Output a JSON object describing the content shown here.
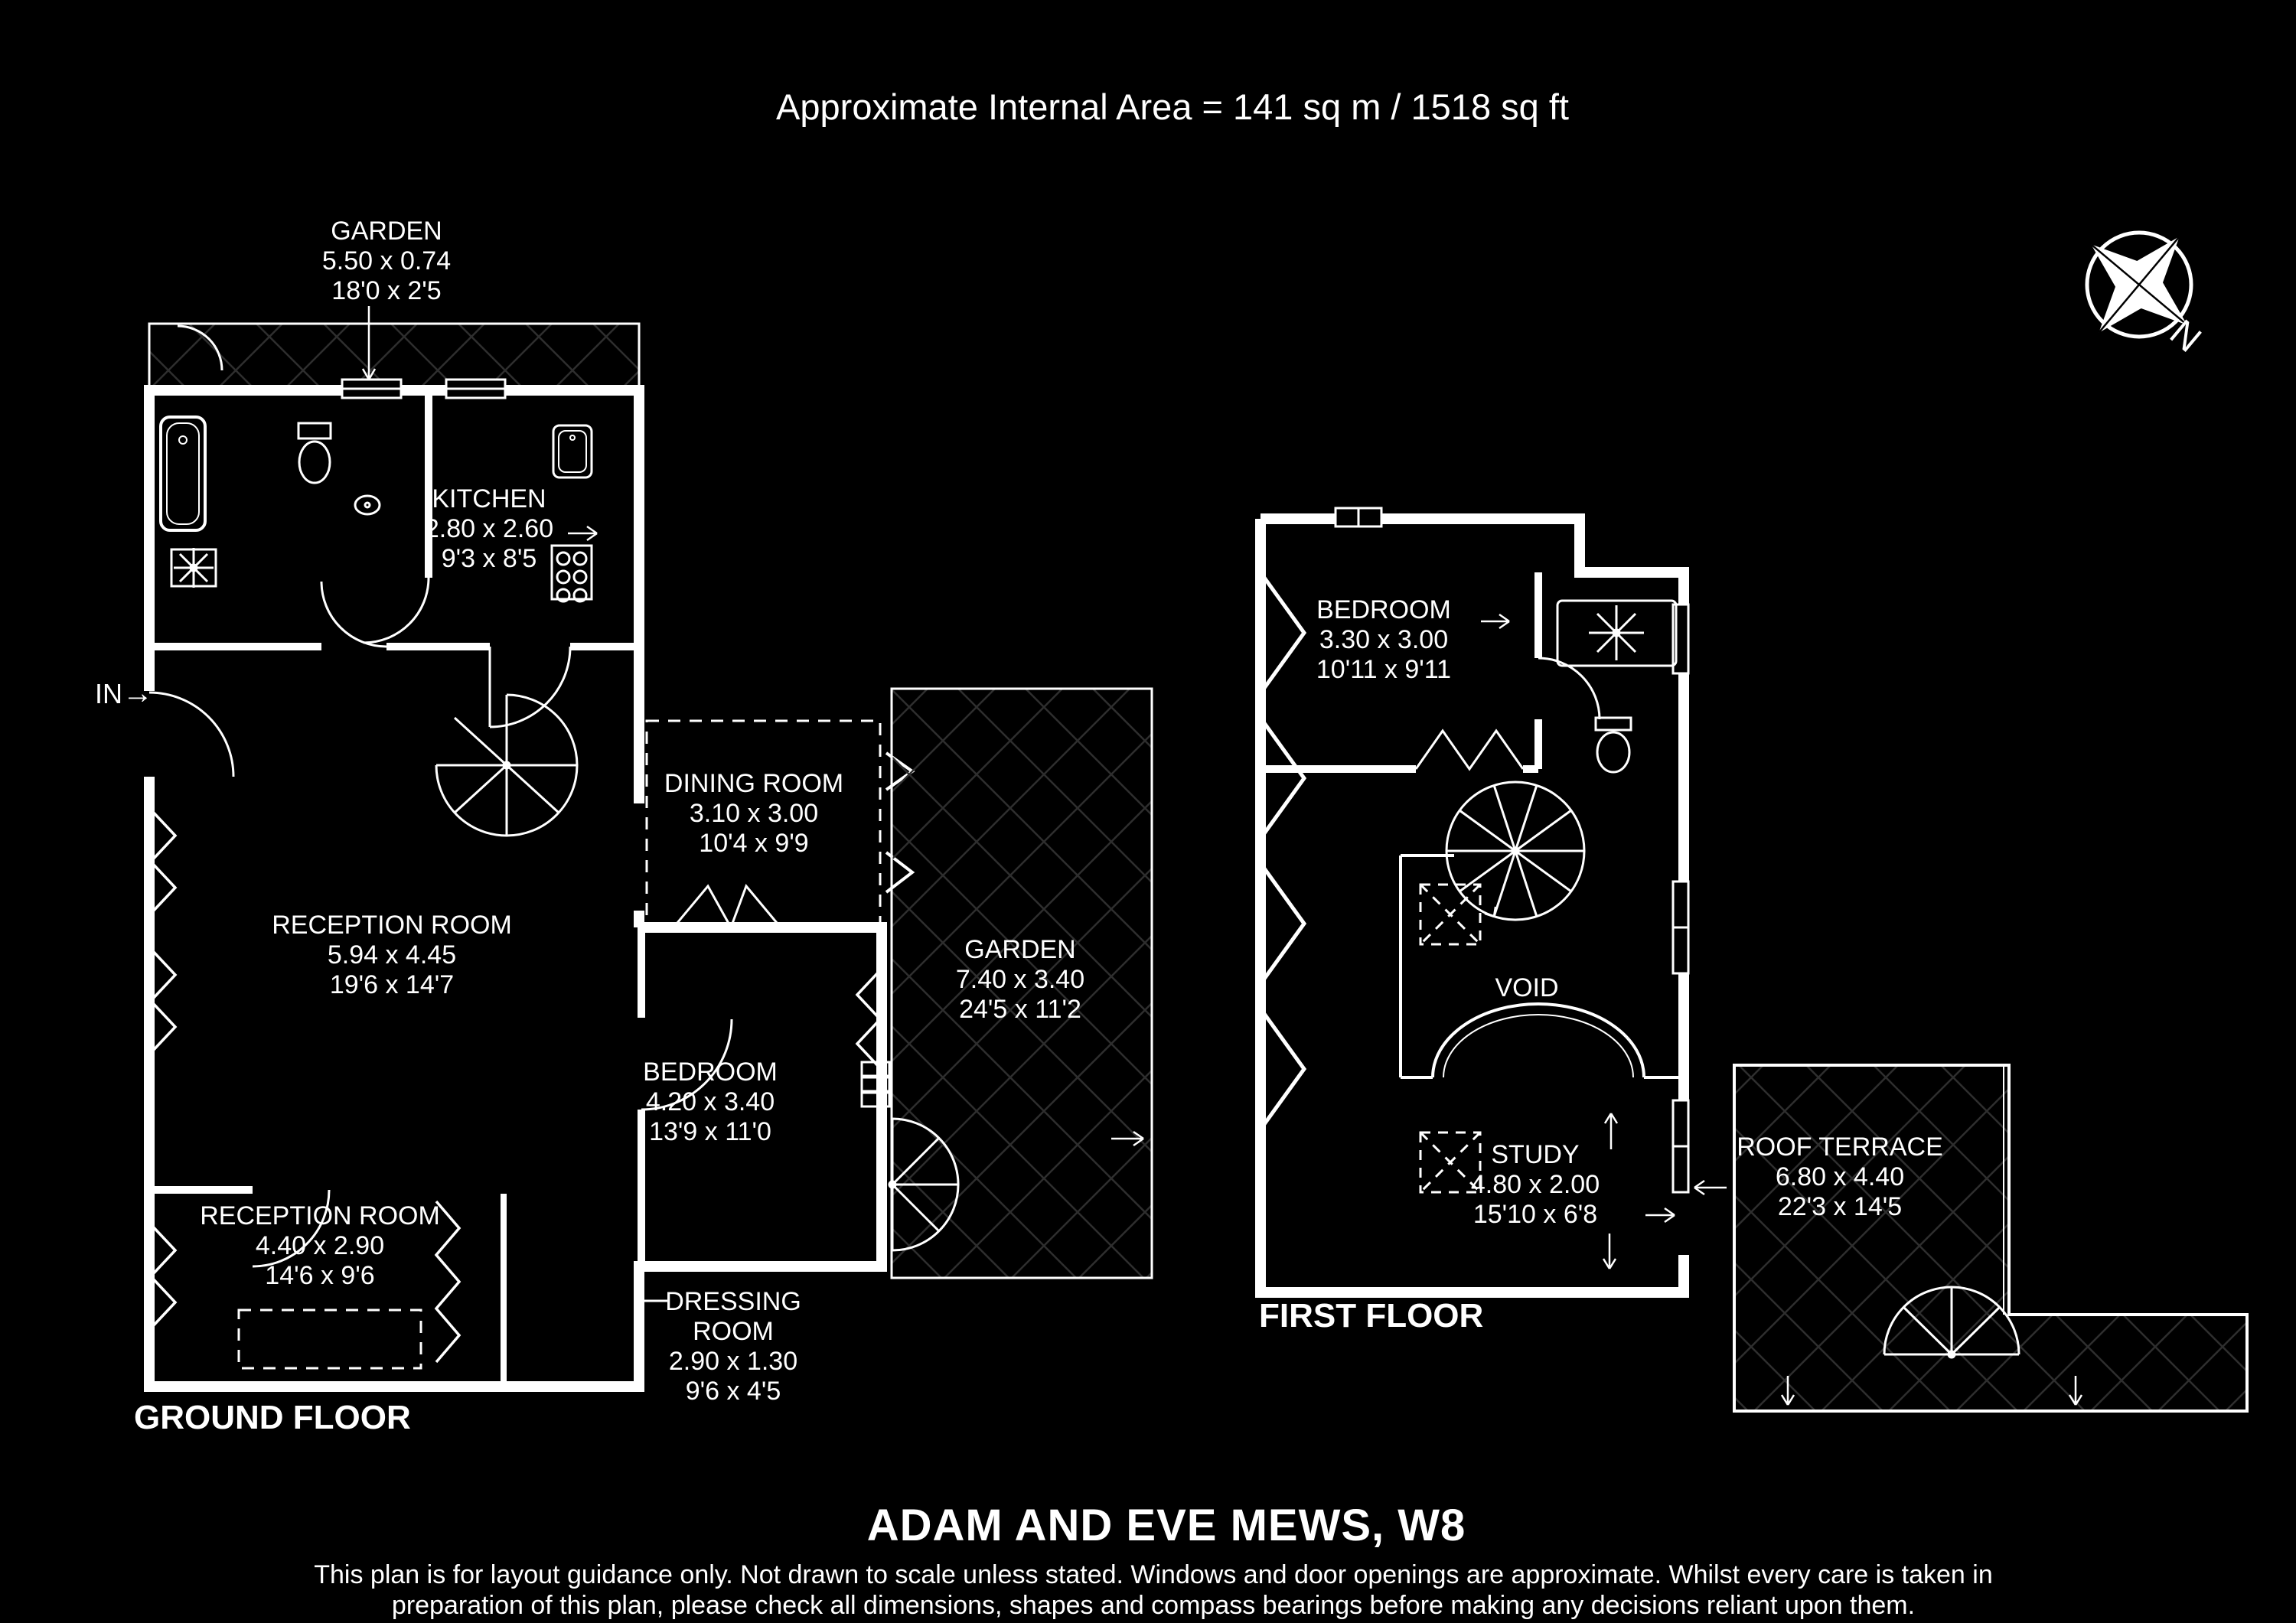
{
  "title": "Approximate Internal Area = 141 sq m / 1518 sq ft",
  "floor_labels": {
    "ground": "GROUND FLOOR",
    "first": "FIRST FLOOR"
  },
  "entry": {
    "label": "IN",
    "arrow": "→"
  },
  "compass": {
    "north_label": "N"
  },
  "rooms": [
    {
      "id": "garden-top",
      "name": "GARDEN",
      "metric": "5.50 x 0.74",
      "imperial": "18'0 x 2'5"
    },
    {
      "id": "kitchen",
      "name": "KITCHEN",
      "metric": "2.80 x 2.60",
      "imperial": "9'3 x 8'5"
    },
    {
      "id": "dining-room",
      "name": "DINING ROOM",
      "metric": "3.10 x 3.00",
      "imperial": "10'4 x 9'9"
    },
    {
      "id": "reception-room",
      "name": "RECEPTION ROOM",
      "metric": "5.94 x 4.45",
      "imperial": "19'6 x 14'7"
    },
    {
      "id": "garden",
      "name": "GARDEN",
      "metric": "7.40 x 3.40",
      "imperial": "24'5 x 11'2"
    },
    {
      "id": "bedroom-ground",
      "name": "BEDROOM",
      "metric": "4.20 x 3.40",
      "imperial": "13'9 x 11'0"
    },
    {
      "id": "reception-room-2",
      "name": "RECEPTION ROOM",
      "metric": "4.40 x 2.90",
      "imperial": "14'6 x 9'6"
    },
    {
      "id": "dressing-room",
      "name": "DRESSING ROOM",
      "metric": "2.90 x 1.30",
      "imperial": "9'6 x 4'5"
    },
    {
      "id": "bedroom-first",
      "name": "BEDROOM",
      "metric": "3.30 x 3.00",
      "imperial": "10'11 x 9'11"
    },
    {
      "id": "void",
      "name": "VOID"
    },
    {
      "id": "study",
      "name": "STUDY",
      "metric": "4.80 x 2.00",
      "imperial": "15'10 x 6'8"
    },
    {
      "id": "roof-terrace",
      "name": "ROOF TERRACE",
      "metric": "6.80 x 4.40",
      "imperial": "22'3 x 14'5"
    }
  ],
  "footer": {
    "address": "ADAM AND EVE MEWS, W8",
    "disclaimer_line1": "This plan is for layout guidance only. Not drawn to scale unless stated. Windows and door openings are approximate. Whilst every care is taken in",
    "disclaimer_line2": "preparation of this plan, please check all dimensions, shapes and compass bearings before making any decisions reliant upon them."
  },
  "colors": {
    "background": "#000000",
    "line": "#ffffff",
    "hatch": "#2e2e2e"
  }
}
